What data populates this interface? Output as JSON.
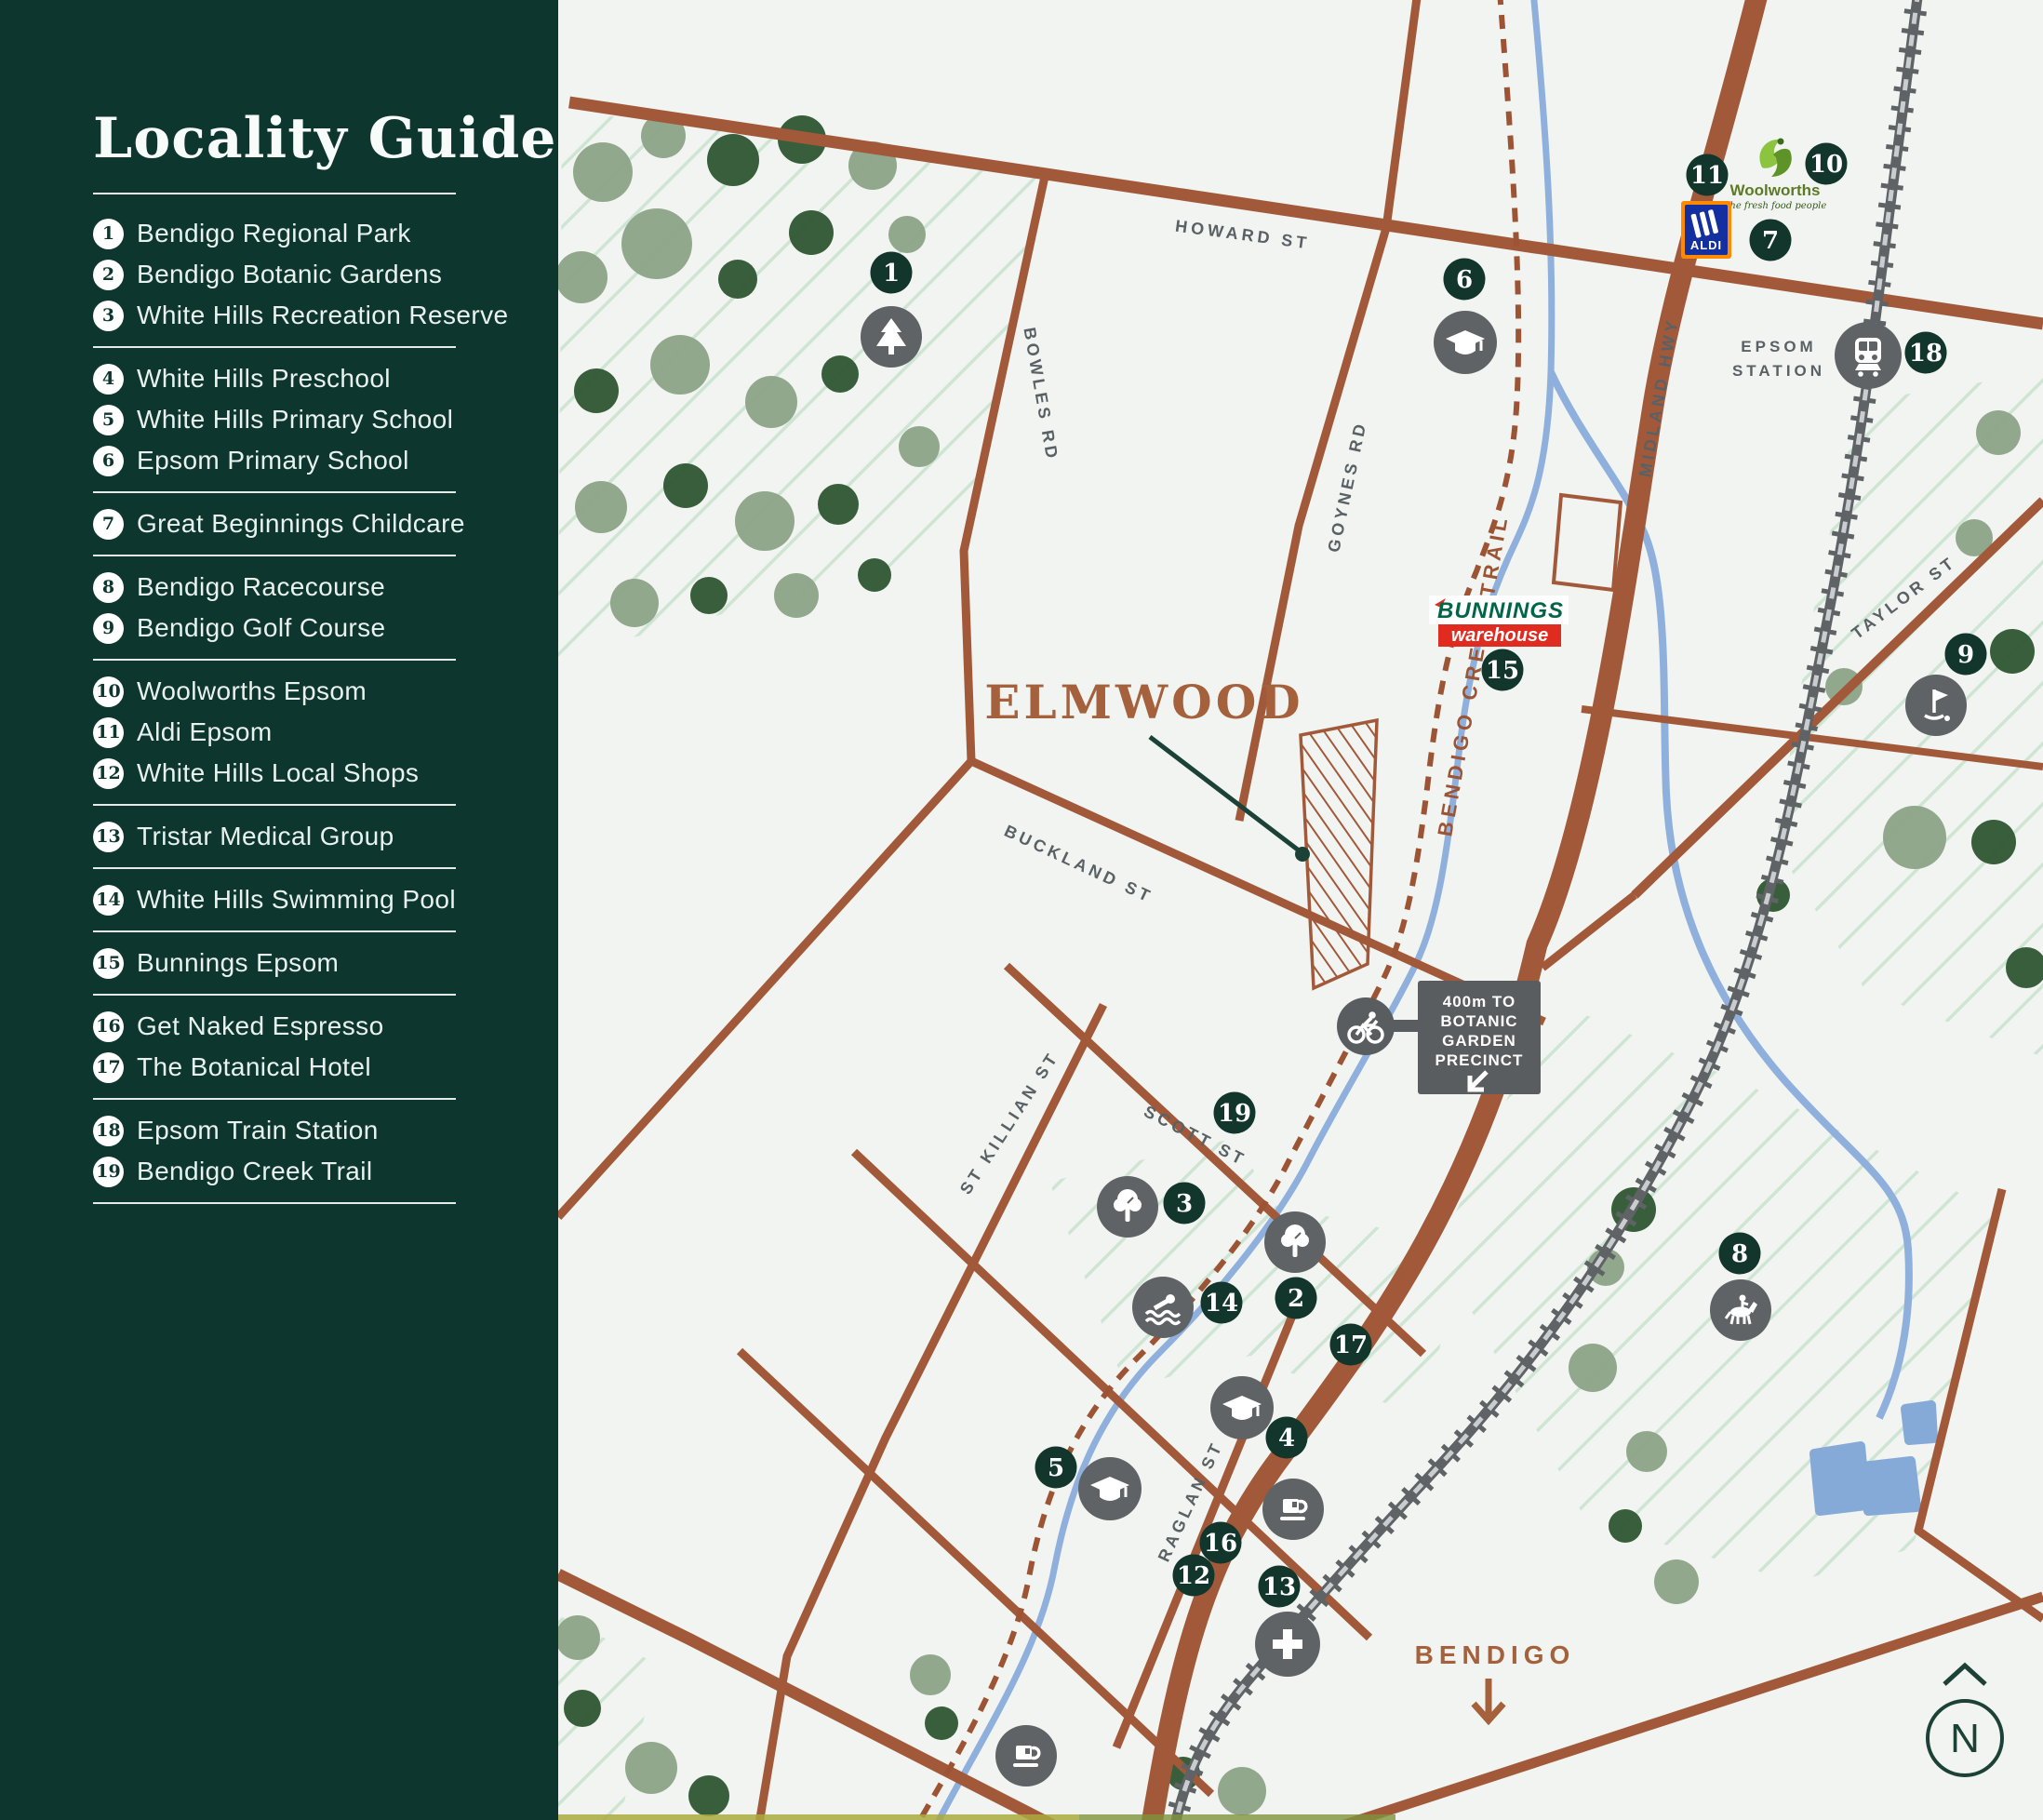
{
  "sidebar": {
    "title": "Locality Guide",
    "groups": [
      {
        "items": [
          {
            "num": "1",
            "label": "Bendigo Regional Park"
          },
          {
            "num": "2",
            "label": "Bendigo Botanic Gardens"
          },
          {
            "num": "3",
            "label": "White Hills Recreation Reserve"
          }
        ]
      },
      {
        "items": [
          {
            "num": "4",
            "label": "White Hills Preschool"
          },
          {
            "num": "5",
            "label": "White Hills Primary School"
          },
          {
            "num": "6",
            "label": "Epsom Primary School"
          }
        ]
      },
      {
        "items": [
          {
            "num": "7",
            "label": "Great Beginnings Childcare"
          }
        ]
      },
      {
        "items": [
          {
            "num": "8",
            "label": "Bendigo Racecourse"
          },
          {
            "num": "9",
            "label": "Bendigo Golf Course"
          }
        ]
      },
      {
        "items": [
          {
            "num": "10",
            "label": "Woolworths Epsom"
          },
          {
            "num": "11",
            "label": "Aldi Epsom"
          },
          {
            "num": "12",
            "label": "White Hills Local Shops"
          }
        ]
      },
      {
        "items": [
          {
            "num": "13",
            "label": "Tristar Medical Group"
          }
        ]
      },
      {
        "items": [
          {
            "num": "14",
            "label": "White Hills Swimming Pool"
          }
        ]
      },
      {
        "items": [
          {
            "num": "15",
            "label": "Bunnings Epsom"
          }
        ]
      },
      {
        "items": [
          {
            "num": "16",
            "label": "Get Naked Espresso"
          },
          {
            "num": "17",
            "label": "The Botanical Hotel"
          }
        ]
      },
      {
        "items": [
          {
            "num": "18",
            "label": "Epsom Train Station"
          },
          {
            "num": "19",
            "label": "Bendigo Creek Trail"
          }
        ]
      }
    ]
  },
  "map": {
    "streets": {
      "howard": "HOWARD ST",
      "bowles": "BOWLES RD",
      "goynes": "GOYNES RD",
      "midland": "MIDLAND HWY",
      "taylor": "TAYLOR ST",
      "buckland": "BUCKLAND ST",
      "stkillian": "ST KILLIAN ST",
      "scott": "SCOTT ST",
      "raglan": "RAGLAN ST",
      "trail": "BENDIGO CREEK TRAIL"
    },
    "labels": {
      "elmwood": "ELMWOOD",
      "bendigo": "BENDIGO",
      "epsom_line1": "EPSOM",
      "epsom_line2": "STATION",
      "north": "N"
    },
    "sign": {
      "lines": [
        "400m TO",
        "BOTANIC",
        "GARDEN",
        "PRECINCT"
      ]
    },
    "logos": {
      "woolworths_name": "Woolworths",
      "woolworths_tagline": "The fresh food people",
      "aldi_name": "ALDI",
      "bunnings_line1": "BUNNINGS",
      "bunnings_line2": "warehouse"
    },
    "markers": [
      "1",
      "2",
      "3",
      "4",
      "5",
      "6",
      "7",
      "8",
      "9",
      "10",
      "11",
      "12",
      "13",
      "14",
      "15",
      "16",
      "17",
      "18",
      "19"
    ],
    "icons": [
      "pine-tree-icon",
      "school-icon",
      "train-icon",
      "golf-icon",
      "tree-icon",
      "swim-icon",
      "coffee-icon",
      "medical-cross-icon",
      "cyclist-icon",
      "horse-riding-icon",
      "north-indicator"
    ]
  },
  "colors": {
    "sidebar_bg": "#0d362e",
    "map_bg": "#f1f4f0",
    "road": "#a2593a",
    "marker_green": "#12362c",
    "icon_gray": "#5f6366",
    "street_label": "#5a6165",
    "creek_blue": "#8fb0dc",
    "trail_brown": "#9c5434",
    "accent_brown": "#a5603c",
    "stripe_green": "#cfe5d4"
  }
}
